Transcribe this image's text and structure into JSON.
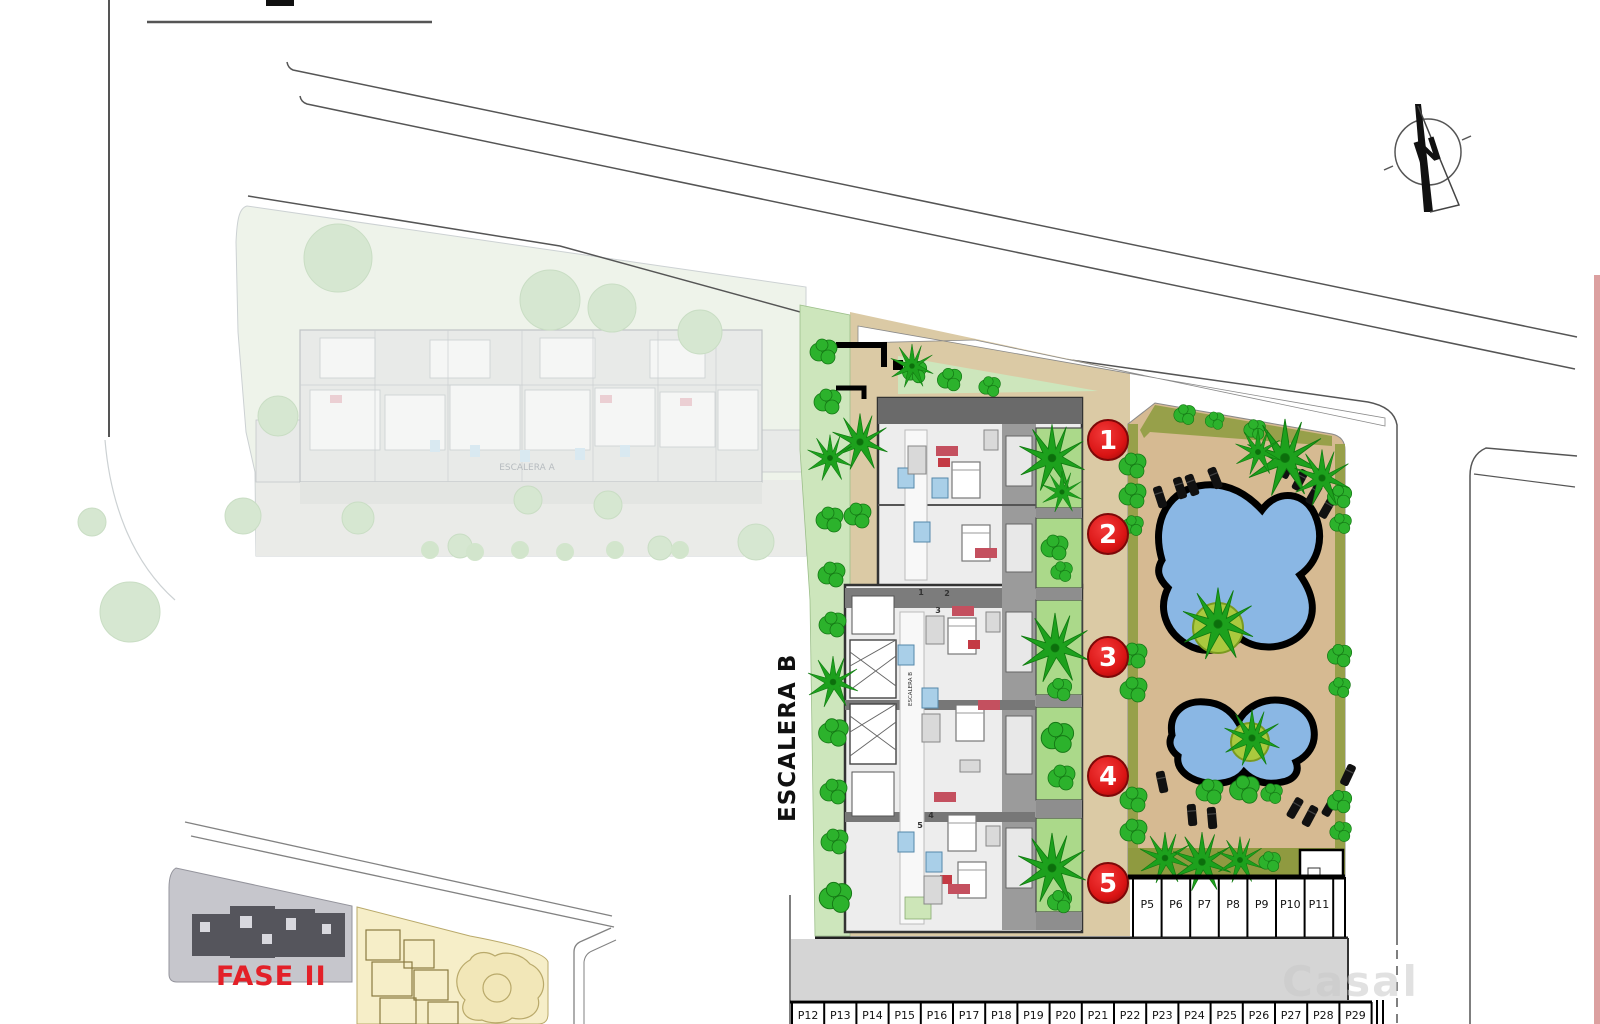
{
  "labels": {
    "stairwell_b_large": "ESCALERA B",
    "stairwell_b_small": "ESCALERA B",
    "stairwell_a": "ESCALERA A",
    "phase_label": "FASE II",
    "north_letter": "N",
    "watermark": "Casal"
  },
  "unit_badges": [
    {
      "number": "1",
      "x": 1108,
      "y": 440
    },
    {
      "number": "2",
      "x": 1108,
      "y": 534
    },
    {
      "number": "3",
      "x": 1108,
      "y": 657
    },
    {
      "number": "4",
      "x": 1108,
      "y": 776
    },
    {
      "number": "5",
      "x": 1108,
      "y": 883
    }
  ],
  "unit_door_numbers": [
    {
      "number": "1",
      "x": 921,
      "y": 595
    },
    {
      "number": "2",
      "x": 947,
      "y": 596
    },
    {
      "number": "3",
      "x": 938,
      "y": 613
    },
    {
      "number": "4",
      "x": 931,
      "y": 818
    },
    {
      "number": "5",
      "x": 920,
      "y": 828
    }
  ],
  "parking": {
    "upper_row": [
      "P5",
      "P6",
      "P7",
      "P8",
      "P9",
      "P10",
      "P11"
    ],
    "lower_row": [
      "P12",
      "P13",
      "P14",
      "P15",
      "P16",
      "P17",
      "P18",
      "P19",
      "P20",
      "P21",
      "P22",
      "P23",
      "P24",
      "P25",
      "P26",
      "P27",
      "P28",
      "P29"
    ]
  },
  "colors": {
    "badge_red": "#e01818",
    "phase_red": "#e32028",
    "pool_blue": "#8ab7e4",
    "deck_tan": "#d6ba92",
    "path_tan": "#dbcaa5",
    "lawn_green": "#cde6bc",
    "bush_green": "#2cb22c",
    "road_grey": "#d5d5d5"
  }
}
